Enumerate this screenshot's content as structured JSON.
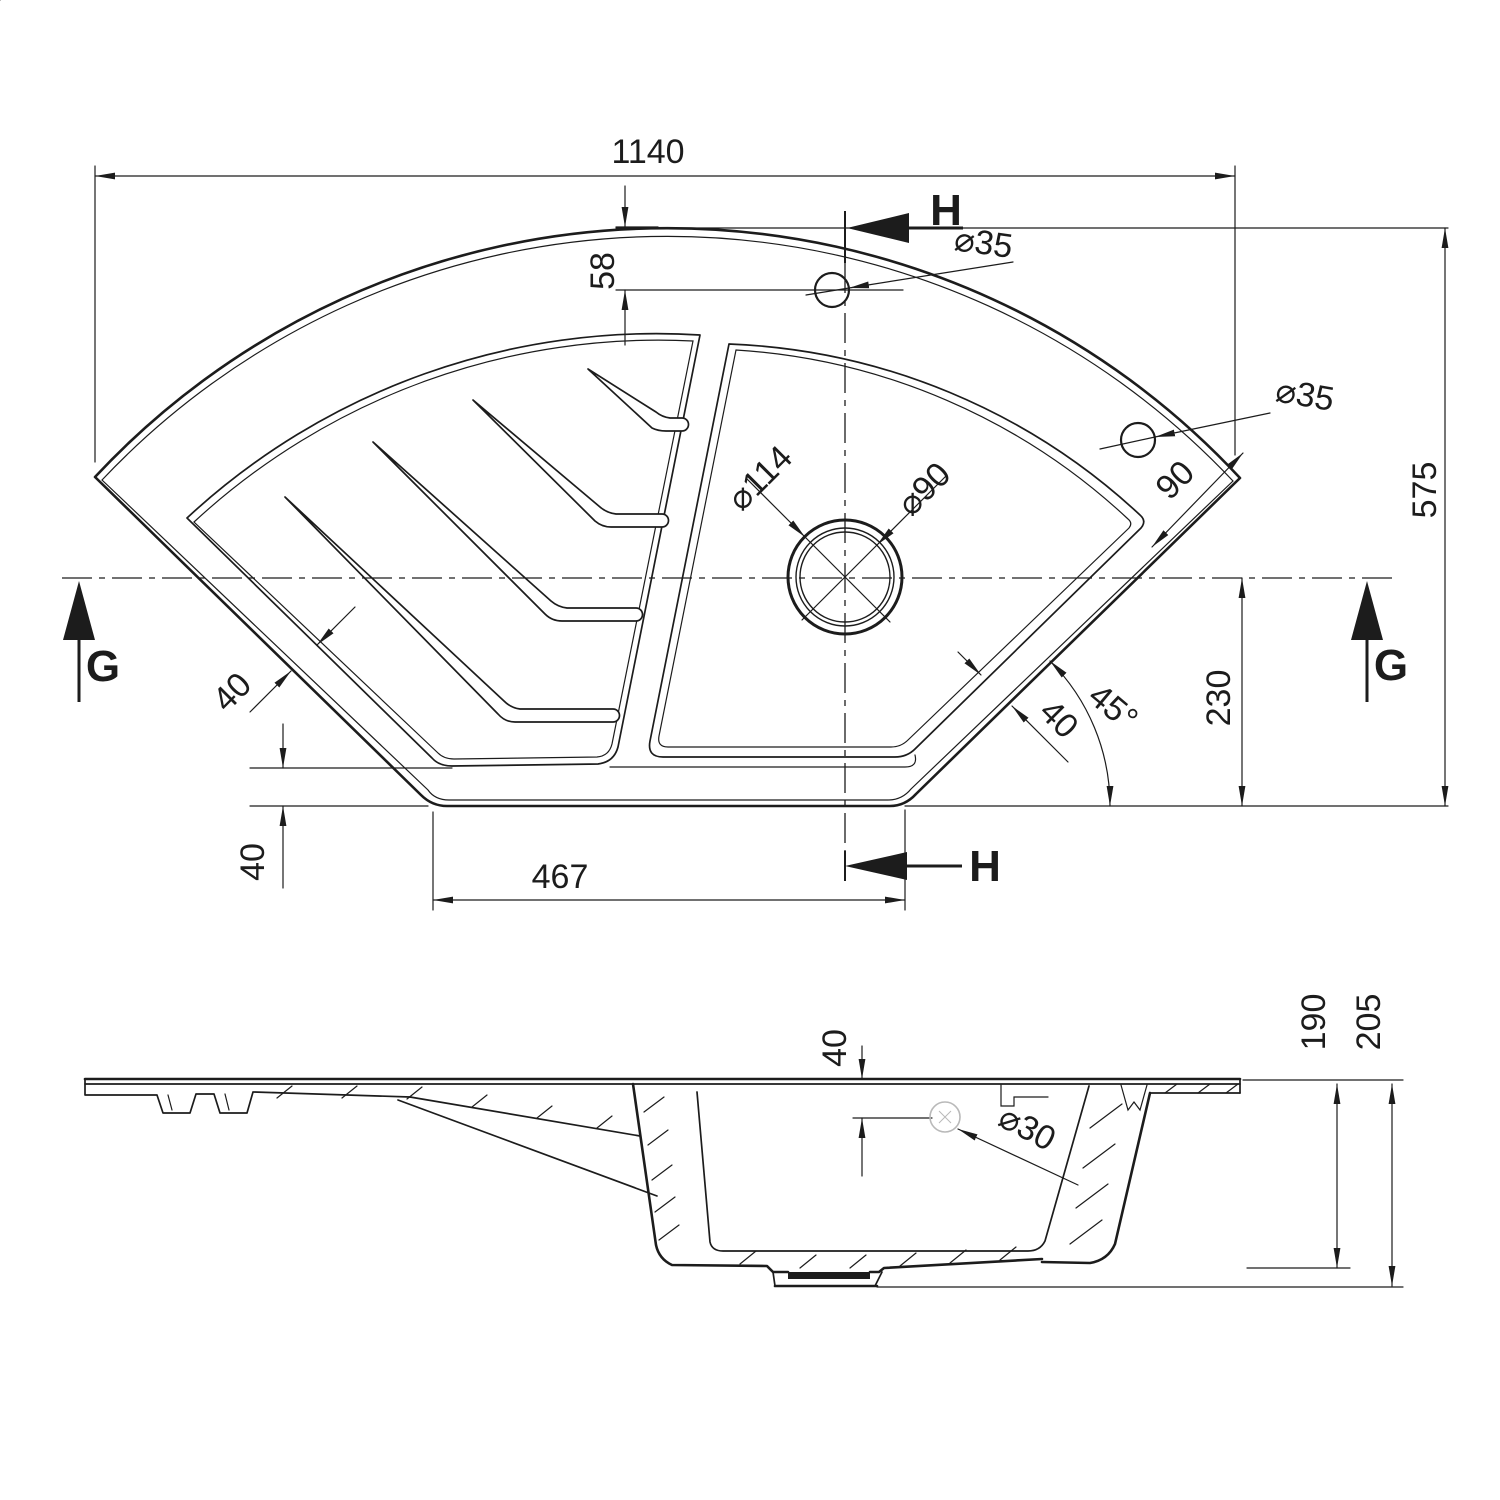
{
  "canvas": {
    "width": 1500,
    "height": 1500,
    "background": "#ffffff",
    "line_color": "#1c1c1c"
  },
  "top_view": {
    "dim_total_width": "1140",
    "dim_tap_hole_offset": "58",
    "section_label_h_top": "H",
    "dim_tap_hole1_diameter": "⌀35",
    "dim_tap_hole2_diameter": "⌀35",
    "dim_corner_offset": "90",
    "dim_total_depth": "575",
    "dim_drain_flange_diameter": "⌀114",
    "dim_drain_diameter": "⌀90",
    "section_label_g_left": "G",
    "section_label_g_right": "G",
    "dim_rim_width_left": "40",
    "dim_rim_width_right": "40",
    "dim_angle": "45°",
    "dim_center_to_bottom": "230",
    "dim_bottom_rim_width": "40",
    "dim_bottom_edge_length": "467",
    "section_label_h_bottom": "H"
  },
  "side_view": {
    "dim_overflow_offset": "40",
    "dim_overflow_diameter": "⌀30",
    "dim_bowl_depth": "190",
    "dim_total_height": "205"
  }
}
